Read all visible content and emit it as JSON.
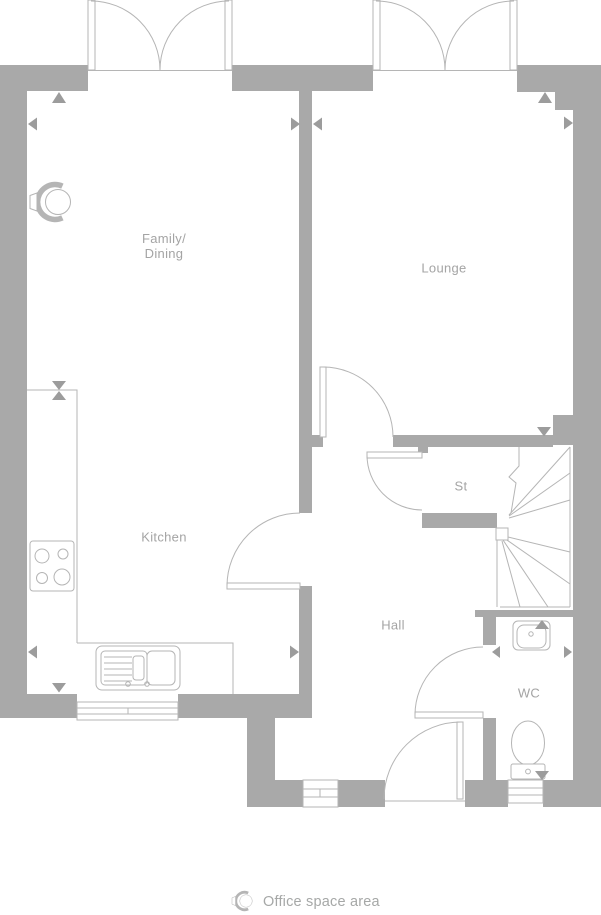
{
  "plan": {
    "type": "ground-floor-plan",
    "rooms": {
      "family_dining": {
        "line1": "Family/",
        "line2": "Dining"
      },
      "lounge": {
        "label": "Lounge"
      },
      "kitchen": {
        "label": "Kitchen"
      },
      "store": {
        "label": "St"
      },
      "hall": {
        "label": "Hall"
      },
      "wc": {
        "label": "WC"
      }
    },
    "legend": {
      "icon": "office-chair-icon",
      "label": "Office space area"
    },
    "fixtures": [
      "french-doors-family",
      "french-doors-lounge",
      "kitchen-counter",
      "hob",
      "sink",
      "winder-stairs",
      "basin",
      "toilet",
      "office-space-marker"
    ],
    "colors": {
      "wall": "#a9a9a9",
      "fixture_line": "#b5b5b5",
      "arrow": "#9c9c9c",
      "label_text": "#a4a4a4",
      "background": "#ffffff"
    }
  }
}
